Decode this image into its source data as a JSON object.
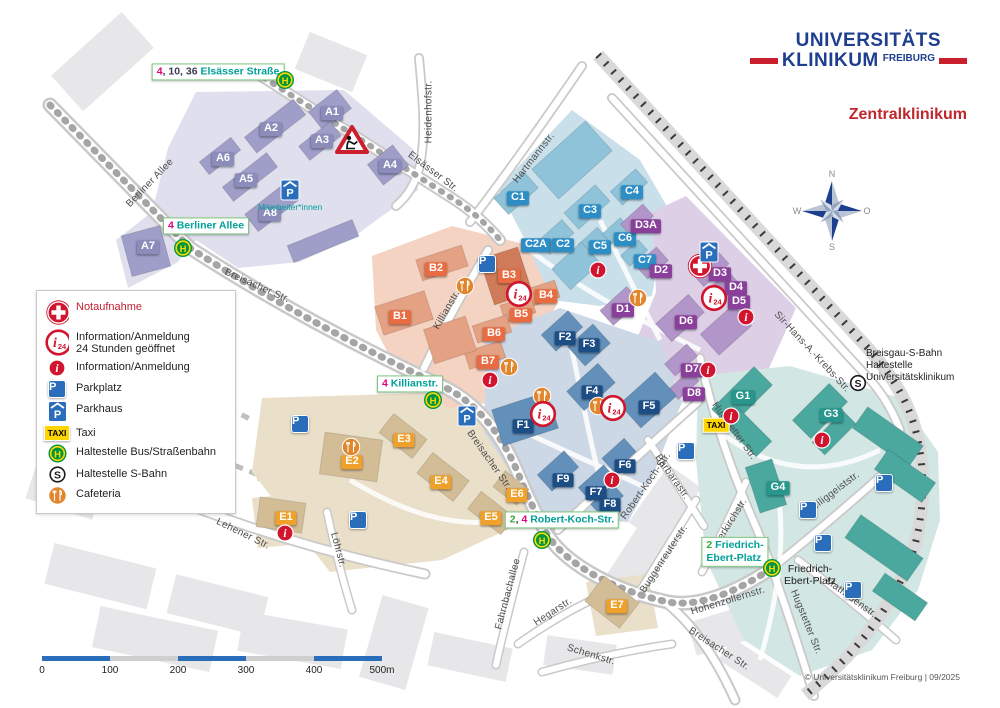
{
  "branding": {
    "logo_line1": "UNIVERSITÄTS",
    "logo_line2": "KLINIKUM",
    "logo_city": "FREIBURG",
    "title": "Zentralklinikum",
    "copyright": "© Universitätsklinikum Freiburg | 09/2025"
  },
  "legend": {
    "items": [
      {
        "icon": "cross",
        "label": "Notaufnahme",
        "red": true
      },
      {
        "icon": "i24",
        "label": "Information/Anmeldung",
        "label2": "24 Stunden geöffnet"
      },
      {
        "icon": "i",
        "label": "Information/Anmeldung"
      },
      {
        "icon": "p",
        "label": "Parkplatz"
      },
      {
        "icon": "ph",
        "label": "Parkhaus"
      },
      {
        "icon": "taxi",
        "label": "Taxi"
      },
      {
        "icon": "h",
        "label": "Haltestelle Bus/Straßenbahn"
      },
      {
        "icon": "s",
        "label": "Haltestelle S-Bahn"
      },
      {
        "icon": "cafe",
        "label": "Cafeteria"
      }
    ]
  },
  "compass": {
    "n": "N",
    "e": "O",
    "s": "S",
    "w": "W"
  },
  "scalebar": {
    "ticks": [
      "0",
      "100",
      "200",
      "300",
      "400",
      "500m"
    ]
  },
  "notes": {
    "sbahn": "Breisgau-S-Bahn\nHaltestelle\nUniversitätsklinikum",
    "parkhaus": "Mitarbeiter*innen"
  },
  "map": {
    "buildings": [
      {
        "id": "A1",
        "g": "A",
        "x": 332,
        "y": 113
      },
      {
        "id": "A2",
        "g": "A",
        "x": 271,
        "y": 129
      },
      {
        "id": "A3",
        "g": "A",
        "x": 322,
        "y": 141
      },
      {
        "id": "A4",
        "g": "A",
        "x": 390,
        "y": 166
      },
      {
        "id": "A5",
        "g": "A",
        "x": 246,
        "y": 180
      },
      {
        "id": "A6",
        "g": "A",
        "x": 223,
        "y": 159
      },
      {
        "id": "A7",
        "g": "A",
        "x": 148,
        "y": 247
      },
      {
        "id": "A8",
        "g": "A",
        "x": 270,
        "y": 214
      },
      {
        "id": "B1",
        "g": "B",
        "x": 400,
        "y": 317
      },
      {
        "id": "B2",
        "g": "B",
        "x": 436,
        "y": 269
      },
      {
        "id": "B3",
        "g": "B",
        "x": 509,
        "y": 276
      },
      {
        "id": "B4",
        "g": "B",
        "x": 546,
        "y": 296
      },
      {
        "id": "B5",
        "g": "B",
        "x": 521,
        "y": 315
      },
      {
        "id": "B6",
        "g": "B",
        "x": 494,
        "y": 334
      },
      {
        "id": "B7",
        "g": "B",
        "x": 488,
        "y": 362
      },
      {
        "id": "C1",
        "g": "C",
        "x": 518,
        "y": 198
      },
      {
        "id": "C2A",
        "g": "C",
        "x": 536,
        "y": 245
      },
      {
        "id": "C2",
        "g": "C",
        "x": 563,
        "y": 245
      },
      {
        "id": "C3",
        "g": "C",
        "x": 590,
        "y": 211
      },
      {
        "id": "C4",
        "g": "C",
        "x": 632,
        "y": 192
      },
      {
        "id": "C5",
        "g": "C",
        "x": 600,
        "y": 247
      },
      {
        "id": "C6",
        "g": "C",
        "x": 625,
        "y": 239
      },
      {
        "id": "C7",
        "g": "C",
        "x": 645,
        "y": 261
      },
      {
        "id": "D1",
        "g": "D",
        "x": 623,
        "y": 310
      },
      {
        "id": "D2",
        "g": "D",
        "x": 661,
        "y": 271
      },
      {
        "id": "D3",
        "g": "D",
        "x": 720,
        "y": 274
      },
      {
        "id": "D3A",
        "g": "D",
        "x": 646,
        "y": 226
      },
      {
        "id": "D4",
        "g": "D",
        "x": 736,
        "y": 288
      },
      {
        "id": "D5",
        "g": "D",
        "x": 739,
        "y": 302
      },
      {
        "id": "D6",
        "g": "D",
        "x": 686,
        "y": 322
      },
      {
        "id": "D7",
        "g": "D",
        "x": 692,
        "y": 370
      },
      {
        "id": "D8",
        "g": "D",
        "x": 694,
        "y": 394
      },
      {
        "id": "E1",
        "g": "E",
        "x": 286,
        "y": 518
      },
      {
        "id": "E2",
        "g": "E",
        "x": 352,
        "y": 462
      },
      {
        "id": "E3",
        "g": "E",
        "x": 404,
        "y": 440
      },
      {
        "id": "E4",
        "g": "E",
        "x": 441,
        "y": 482
      },
      {
        "id": "E5",
        "g": "E",
        "x": 491,
        "y": 518
      },
      {
        "id": "E6",
        "g": "E",
        "x": 517,
        "y": 495
      },
      {
        "id": "E7",
        "g": "E",
        "x": 617,
        "y": 606
      },
      {
        "id": "F1",
        "g": "F",
        "x": 523,
        "y": 426
      },
      {
        "id": "F2",
        "g": "F",
        "x": 565,
        "y": 338
      },
      {
        "id": "F3",
        "g": "F",
        "x": 589,
        "y": 345
      },
      {
        "id": "F4",
        "g": "F",
        "x": 592,
        "y": 392
      },
      {
        "id": "F5",
        "g": "F",
        "x": 649,
        "y": 407
      },
      {
        "id": "F6",
        "g": "F",
        "x": 625,
        "y": 466
      },
      {
        "id": "F7",
        "g": "F",
        "x": 596,
        "y": 493
      },
      {
        "id": "F8",
        "g": "F",
        "x": 610,
        "y": 505
      },
      {
        "id": "F9",
        "g": "F",
        "x": 563,
        "y": 480
      },
      {
        "id": "G1",
        "g": "G",
        "x": 743,
        "y": 397
      },
      {
        "id": "G3",
        "g": "G",
        "x": 831,
        "y": 415
      },
      {
        "id": "G4",
        "g": "G",
        "x": 778,
        "y": 488
      }
    ],
    "streets": [
      {
        "t": "Berliner Allee",
        "x": 150,
        "y": 183,
        "r": -46
      },
      {
        "t": "Elsässer Str.",
        "x": 433,
        "y": 172,
        "r": 37
      },
      {
        "t": "Heidenhofstr.",
        "x": 429,
        "y": 112,
        "r": -90
      },
      {
        "t": "Hartmannstr.",
        "x": 534,
        "y": 158,
        "r": -52
      },
      {
        "t": "Breisacher Str.",
        "x": 257,
        "y": 286,
        "r": 24
      },
      {
        "t": "Killianstr.",
        "x": 447,
        "y": 310,
        "r": -60
      },
      {
        "t": "Breisacher Str.",
        "x": 489,
        "y": 460,
        "r": 55
      },
      {
        "t": "Sir-Hans-A.-Krebs-Str.",
        "x": 812,
        "y": 352,
        "r": 47
      },
      {
        "t": "Robert-Koch-Str.",
        "x": 646,
        "y": 486,
        "r": -55
      },
      {
        "t": "Barbarastr.",
        "x": 672,
        "y": 477,
        "r": 55
      },
      {
        "t": "Buggenreuterstr.",
        "x": 664,
        "y": 559,
        "r": -57
      },
      {
        "t": "Lutherkirchstr.",
        "x": 727,
        "y": 528,
        "r": -58
      },
      {
        "t": "Hugstetter Str.",
        "x": 734,
        "y": 431,
        "r": 54
      },
      {
        "t": "Hugstetter Str.",
        "x": 806,
        "y": 622,
        "r": 68
      },
      {
        "t": "Heiliggeiststr.",
        "x": 833,
        "y": 493,
        "r": -37
      },
      {
        "t": "Mathildenstr.",
        "x": 851,
        "y": 598,
        "r": 36
      },
      {
        "t": "Hohenzollernstr.",
        "x": 728,
        "y": 601,
        "r": -17
      },
      {
        "t": "Breisacher Str.",
        "x": 719,
        "y": 649,
        "r": 33
      },
      {
        "t": "Lehener Str.",
        "x": 243,
        "y": 534,
        "r": 26
      },
      {
        "t": "Löhrstr.",
        "x": 338,
        "y": 550,
        "r": 75
      },
      {
        "t": "Fahrnbachallee",
        "x": 508,
        "y": 594,
        "r": -75
      },
      {
        "t": "Hegarstr.",
        "x": 553,
        "y": 612,
        "r": -33
      },
      {
        "t": "Schenkstr.",
        "x": 591,
        "y": 655,
        "r": 17
      },
      {
        "t": "Friedrich-\nEbert-Platz",
        "x": 810,
        "y": 575,
        "r": 0,
        "plain": true
      }
    ],
    "stops": [
      {
        "name": "elsaesser-strasse",
        "x": 218,
        "y": 72,
        "hx": 285,
        "hy": 80,
        "lines": [
          [
            {
              "t": "4",
              "c": "l4"
            },
            {
              "t": ", 10, 36 ",
              "c": "pl"
            },
            {
              "t": "Elsässer Straße",
              "c": "nm"
            }
          ]
        ]
      },
      {
        "name": "berliner-allee",
        "x": 206,
        "y": 226,
        "hx": 183,
        "hy": 248,
        "lines": [
          [
            {
              "t": "4",
              "c": "l4"
            },
            {
              "t": " ",
              "c": "pl"
            },
            {
              "t": "Berliner Allee",
              "c": "nm"
            }
          ]
        ]
      },
      {
        "name": "killianstr",
        "x": 410,
        "y": 384,
        "hx": 433,
        "hy": 400,
        "lines": [
          [
            {
              "t": "4",
              "c": "l4"
            },
            {
              "t": " ",
              "c": "pl"
            },
            {
              "t": "Killianstr.",
              "c": "nm"
            }
          ]
        ]
      },
      {
        "name": "robert-koch-str",
        "x": 562,
        "y": 520,
        "hx": 542,
        "hy": 540,
        "lines": [
          [
            {
              "t": "2",
              "c": "l2"
            },
            {
              "t": ", ",
              "c": "pl"
            },
            {
              "t": "4",
              "c": "l4"
            },
            {
              "t": " ",
              "c": "pl"
            },
            {
              "t": "Robert-Koch-Str.",
              "c": "nm"
            }
          ]
        ]
      },
      {
        "name": "friedrich-ebert-platz",
        "x": 735,
        "y": 552,
        "hx": 772,
        "hy": 568,
        "lines": [
          [
            {
              "t": "2",
              "c": "l2"
            },
            {
              "t": " Friedrich-",
              "c": "nm"
            }
          ],
          [
            {
              "t": "Ebert-Platz",
              "c": "nm"
            }
          ]
        ]
      }
    ],
    "icons": [
      {
        "type": "constr",
        "x": 352,
        "y": 140
      },
      {
        "type": "ph",
        "x": 290,
        "y": 190
      },
      {
        "type": "p",
        "x": 487,
        "y": 264
      },
      {
        "type": "cafe",
        "x": 465,
        "y": 286
      },
      {
        "type": "i24",
        "x": 519,
        "y": 294
      },
      {
        "type": "i",
        "x": 490,
        "y": 380
      },
      {
        "type": "cafe",
        "x": 509,
        "y": 367
      },
      {
        "type": "cross",
        "x": 700,
        "y": 266
      },
      {
        "type": "ph",
        "x": 709,
        "y": 252
      },
      {
        "type": "i24",
        "x": 714,
        "y": 298
      },
      {
        "type": "i",
        "x": 746,
        "y": 317
      },
      {
        "type": "i",
        "x": 598,
        "y": 270
      },
      {
        "type": "cafe",
        "x": 638,
        "y": 298
      },
      {
        "type": "i",
        "x": 708,
        "y": 370
      },
      {
        "type": "cafe",
        "x": 542,
        "y": 396
      },
      {
        "type": "i24",
        "x": 543,
        "y": 414
      },
      {
        "type": "cafe",
        "x": 598,
        "y": 406
      },
      {
        "type": "i24",
        "x": 613,
        "y": 408
      },
      {
        "type": "i",
        "x": 612,
        "y": 480
      },
      {
        "type": "i",
        "x": 285,
        "y": 533
      },
      {
        "type": "cafe",
        "x": 351,
        "y": 447
      },
      {
        "type": "ph",
        "x": 467,
        "y": 416
      },
      {
        "type": "taxi",
        "x": 716,
        "y": 425
      },
      {
        "type": "i",
        "x": 731,
        "y": 416
      },
      {
        "type": "i",
        "x": 822,
        "y": 440
      },
      {
        "type": "s",
        "x": 858,
        "y": 383
      },
      {
        "type": "p",
        "x": 300,
        "y": 424
      },
      {
        "type": "p",
        "x": 358,
        "y": 520
      },
      {
        "type": "p",
        "x": 686,
        "y": 451
      },
      {
        "type": "p",
        "x": 884,
        "y": 483
      },
      {
        "type": "p",
        "x": 808,
        "y": 510
      },
      {
        "type": "p",
        "x": 823,
        "y": 543
      },
      {
        "type": "p",
        "x": 853,
        "y": 590
      }
    ]
  },
  "colors": {
    "brand_blue": "#1e3f8f",
    "brand_red": "#cc1f2e",
    "title_red": "#c0272d",
    "line2_green": "#3aaa35",
    "line4_magenta": "#e5007d",
    "stop_name_teal": "#00a099",
    "stop_border": "#7cc47c",
    "icon_red": "#d2152e",
    "parking_blue": "#2a6ebb",
    "taxi_yellow": "#ffd500",
    "hst_green": "#009640",
    "hst_yellow": "#ffd800",
    "cafeteria_orange": "#e0862c",
    "zoneA": "#dfdfee",
    "bldA": "#9e9ec9",
    "labelA": "#8c8cbb",
    "zoneB": "#f4d3c2",
    "bldB": "#e5a183",
    "labelB": "#e96b42",
    "zoneC": "#c9e0eb",
    "bldC": "#8fc3d9",
    "labelC": "#2d8ec6",
    "zoneD": "#ddd0e6",
    "bldD": "#b295c9",
    "labelD": "#8a3f9b",
    "zoneE": "#eadfc8",
    "bldE": "#d3bd97",
    "labelE": "#f0a12b",
    "zoneF": "#ccd8e6",
    "bldF": "#6390ba",
    "labelF": "#1c4d84",
    "zoneG": "#d2e6e3",
    "bldG": "#4aa89f",
    "labelG": "#27968c"
  }
}
